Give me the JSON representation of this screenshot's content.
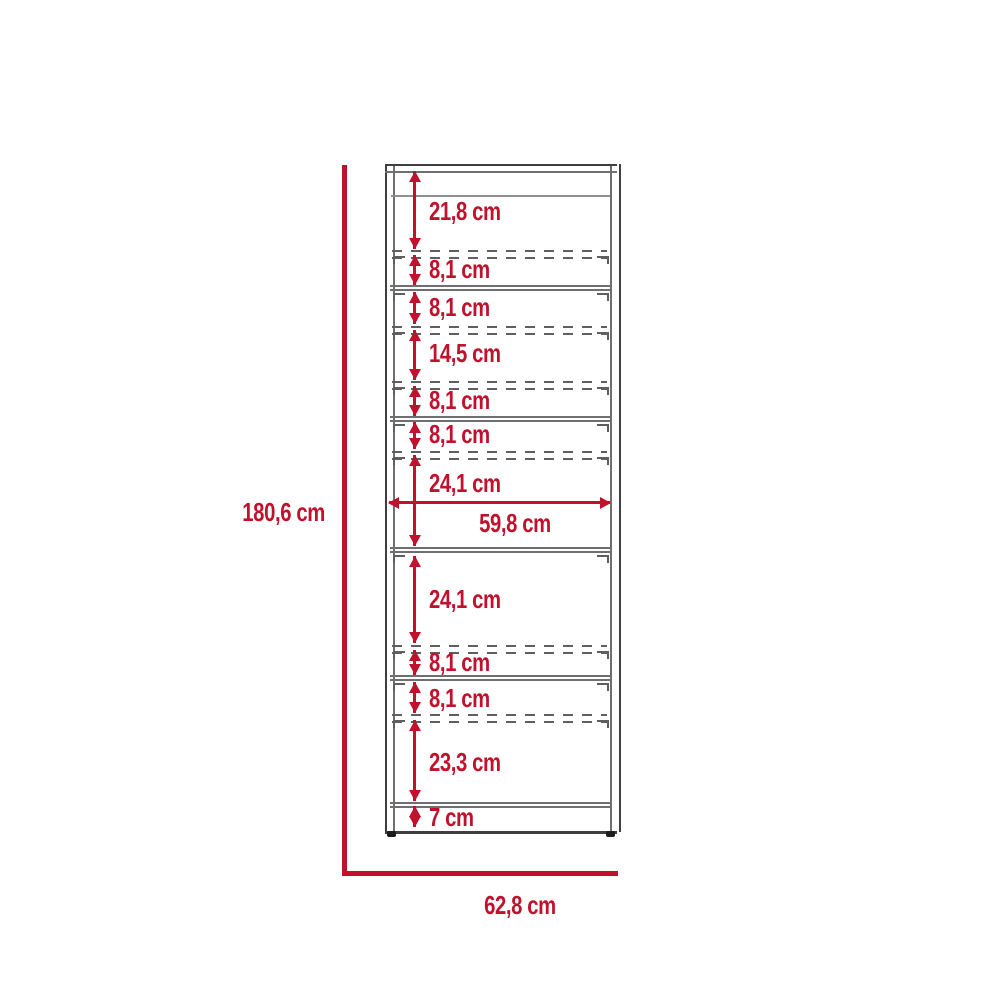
{
  "diagram": {
    "type": "furniture-dimension-diagram",
    "unit": "cm",
    "colors": {
      "dimension_red": "#c0122d",
      "structure_gray": "#3f3f3f",
      "background": "#ffffff"
    },
    "overall_dimensions": {
      "height": {
        "label": "180,6 cm",
        "value": 180.6
      },
      "width": {
        "label": "62,8 cm",
        "value": 62.8
      },
      "inner_width": {
        "label": "59,8 cm",
        "value": 59.8
      }
    },
    "section_dimensions": [
      {
        "label": "21,8 cm",
        "value": 21.8
      },
      {
        "label": "8,1 cm",
        "value": 8.1
      },
      {
        "label": "8,1 cm",
        "value": 8.1
      },
      {
        "label": "14,5 cm",
        "value": 14.5
      },
      {
        "label": "8,1 cm",
        "value": 8.1
      },
      {
        "label": "8,1 cm",
        "value": 8.1
      },
      {
        "label": "24,1 cm",
        "value": 24.1
      },
      {
        "label": "24,1 cm",
        "value": 24.1
      },
      {
        "label": "8,1 cm",
        "value": 8.1
      },
      {
        "label": "8,1 cm",
        "value": 8.1
      },
      {
        "label": "23,3 cm",
        "value": 23.3
      },
      {
        "label": "7 cm",
        "value": 7
      }
    ]
  }
}
